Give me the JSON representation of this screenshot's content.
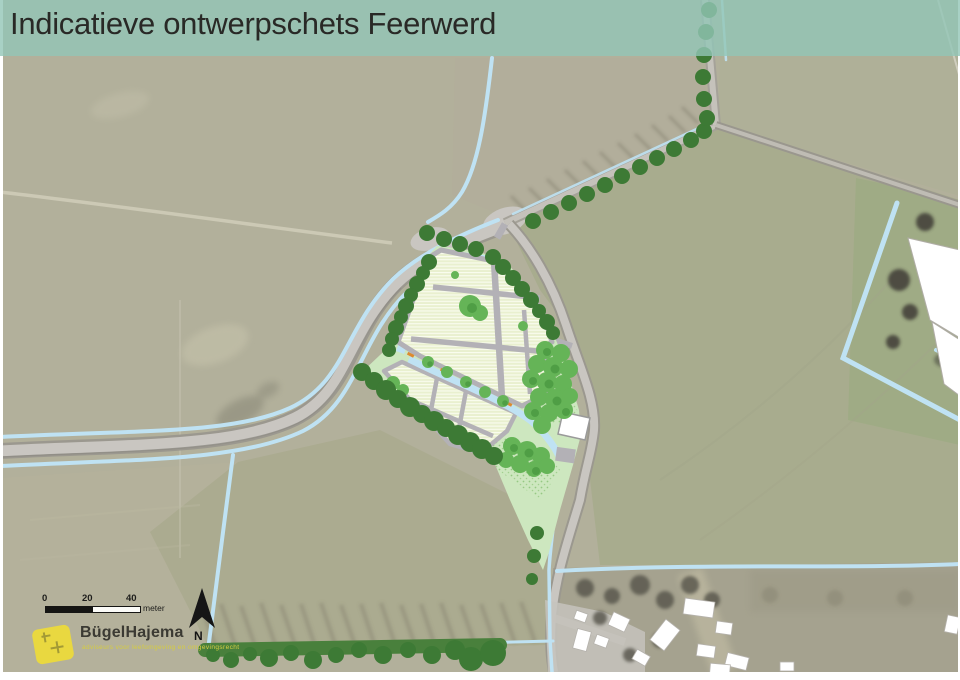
{
  "title_bar": {
    "text": "Indicatieve ontwerpschets Feerwerd",
    "background_color": "#92c5b6"
  },
  "scale_bar": {
    "tick_0": "0",
    "tick_20": "20",
    "tick_40": "40",
    "unit": "meter"
  },
  "north_indicator": {
    "label": "N"
  },
  "logo": {
    "company": "BügelHajema",
    "tagline": "adviseurs voor leefomgeving en omgevingsrecht",
    "accent_color": "#e9d840"
  },
  "legend_colors": {
    "boundary_tree_green": "#3d7a35",
    "garden_tree_green": "#65b457",
    "lawn_green": "#cde7bf",
    "plot_stripe_cream": "#e9f0cf",
    "path_gray": "#b3b1b6",
    "water_blue": "#bfe2f3",
    "road_gray": "#c8c5bf",
    "aerial_field_olive": "#b2b09b"
  }
}
